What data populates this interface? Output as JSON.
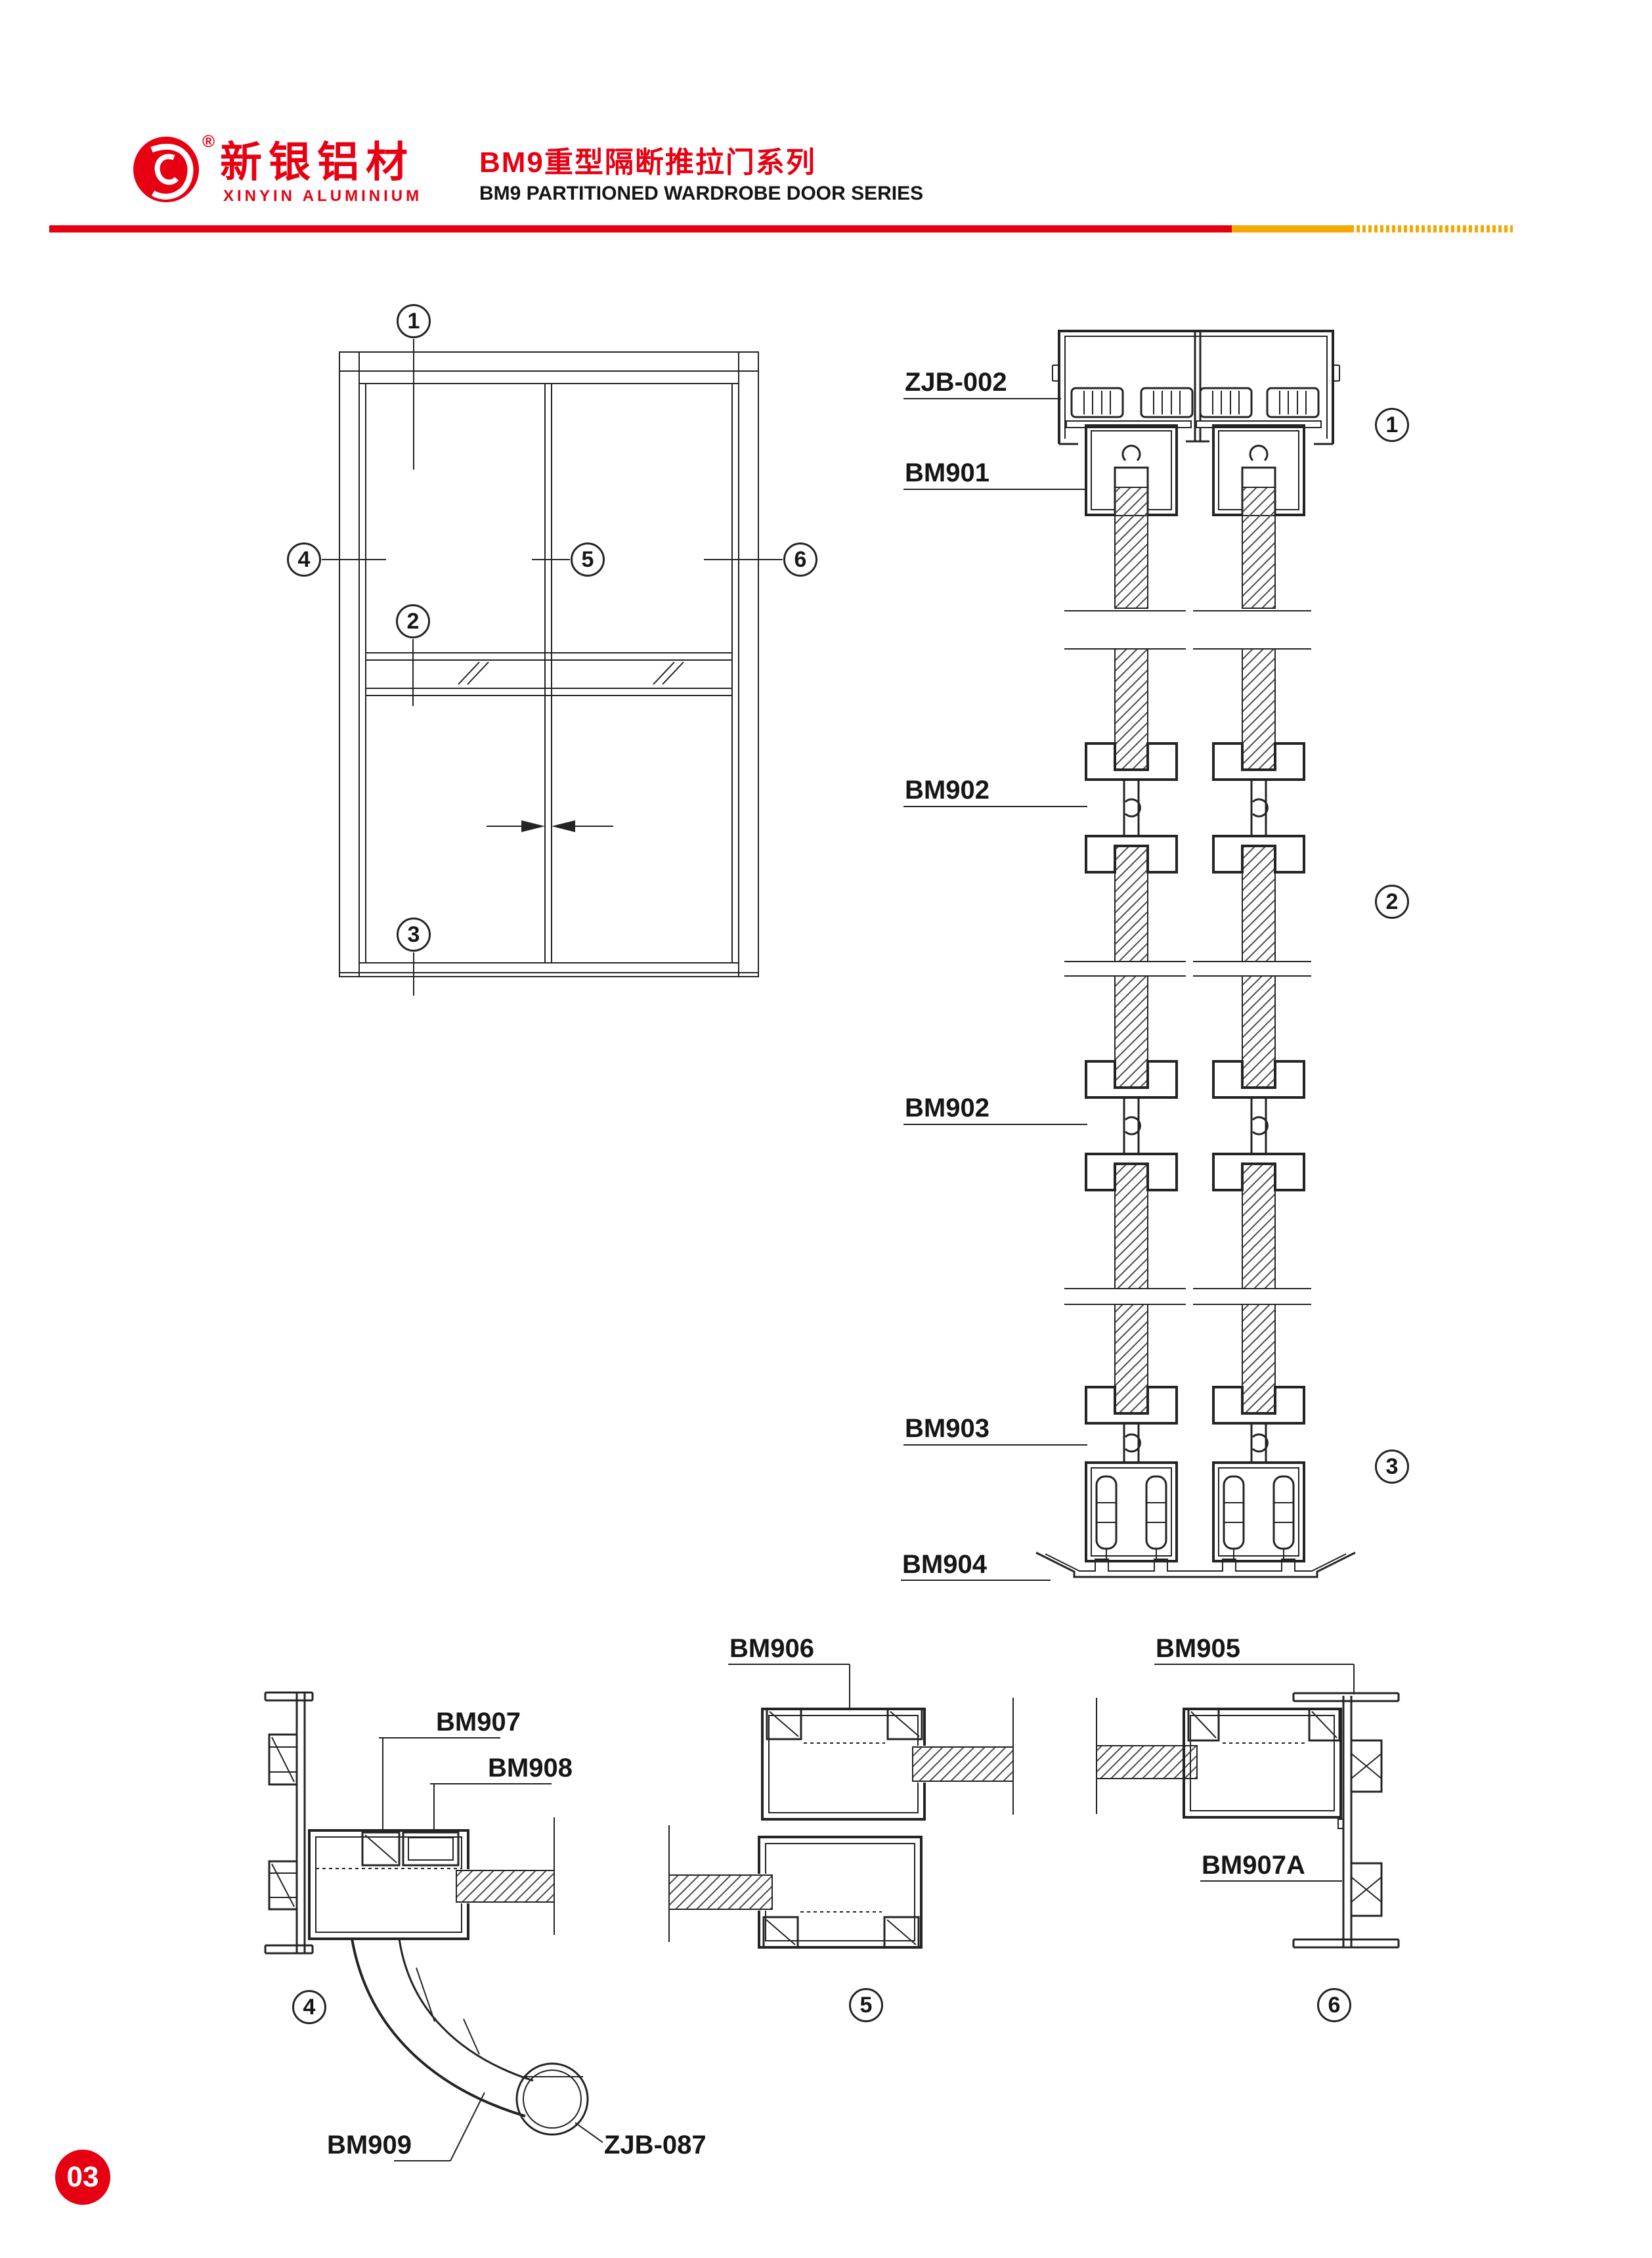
{
  "header": {
    "brand_cn": "新银铝材",
    "brand_en": "XINYIN ALUMINIUM",
    "registered": "®",
    "title_cn": "BM9重型隔断推拉门系列",
    "title_en": "BM9 PARTITIONED WARDROBE DOOR SERIES",
    "colors": {
      "red": "#e60012",
      "gold": "#f5a800",
      "ink": "#242424"
    }
  },
  "elevation": {
    "callouts": {
      "c1": "1",
      "c2": "2",
      "c3": "3",
      "c4": "4",
      "c5": "5",
      "c6": "6"
    }
  },
  "section": {
    "labels": {
      "zjb002": "ZJB-002",
      "bm901": "BM901",
      "bm902a": "BM902",
      "bm902b": "BM902",
      "bm903": "BM903",
      "bm904": "BM904"
    },
    "callouts": {
      "c1": "1",
      "c2": "2",
      "c3": "3"
    }
  },
  "details": {
    "labels": {
      "bm906": "BM906",
      "bm905": "BM905",
      "bm907": "BM907",
      "bm908": "BM908",
      "bm907a": "BM907A",
      "bm909": "BM909",
      "zjb087": "ZJB-087"
    },
    "callouts": {
      "c4": "4",
      "c5": "5",
      "c6": "6"
    }
  },
  "footer": {
    "page_number": "03"
  }
}
